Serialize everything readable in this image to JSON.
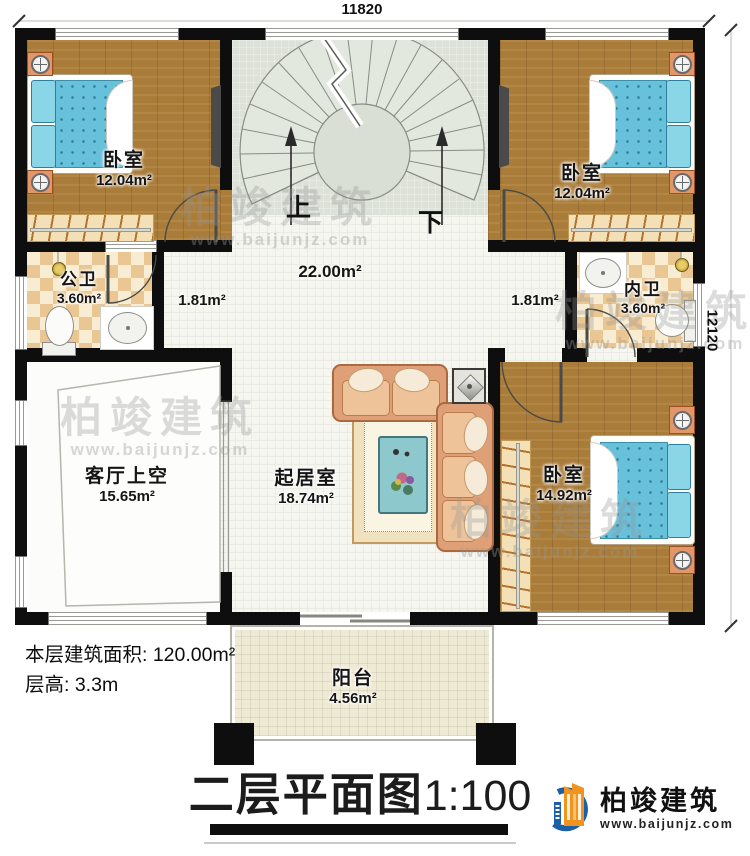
{
  "dimensions": {
    "width": "11820",
    "height": "12120"
  },
  "rooms": {
    "bedroom_tl": {
      "name": "卧室",
      "area": "12.04m²"
    },
    "bedroom_tr": {
      "name": "卧室",
      "area": "12.04m²"
    },
    "bedroom_br": {
      "name": "卧室",
      "area": "14.92m²"
    },
    "public_bath": {
      "name": "公卫",
      "area": "3.60m²"
    },
    "inner_bath": {
      "name": "内卫",
      "area": "3.60m²"
    },
    "living_void": {
      "name": "客厅上空",
      "area": "15.65m²"
    },
    "living_room": {
      "name": "起居室",
      "area": "18.74m²"
    },
    "balcony": {
      "name": "阳台",
      "area": "4.56m²"
    },
    "hall": {
      "area": "22.00m²"
    },
    "corridor_left": {
      "area": "1.81m²"
    },
    "corridor_right": {
      "area": "1.81m²"
    }
  },
  "stairs": {
    "up_label": "上",
    "down_label": "下"
  },
  "info": {
    "area_line": "本层建筑面积: 120.00m²",
    "height_line": "层高: 3.3m"
  },
  "title": {
    "text": "二层平面图",
    "scale": "1:100"
  },
  "brand": {
    "name": "柏竣建筑",
    "site": "www.baijunjz.com"
  },
  "watermark": {
    "name": "柏竣建筑",
    "site": "www.baijunjz.com"
  },
  "colors": {
    "wall": "#0e0e0e",
    "wood_floor": "#a97c3a",
    "stair_floor": "#dde2d8",
    "bath_tile_a": "#eac692",
    "bath_tile_b": "#f8edd3",
    "balcony_floor": "#efead3",
    "mattress_blue": "#67c1db",
    "sofa_tan": "#dfa077",
    "brand_blue": "#1c5fa8",
    "brand_orange": "#f0941d"
  }
}
